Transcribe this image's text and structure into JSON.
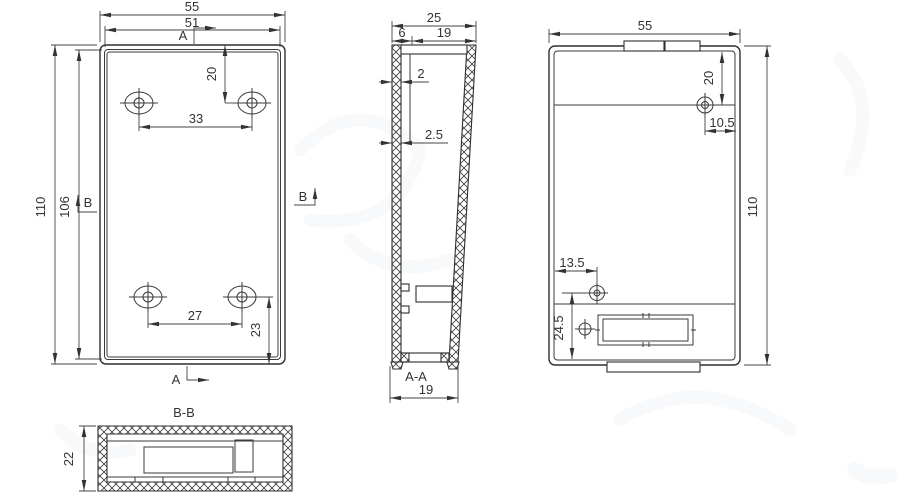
{
  "drawing": {
    "front_view": {
      "dim_width_outer": "55",
      "dim_width_inner": "51",
      "dim_height_outer": "110",
      "dim_height_inner": "106",
      "dim_hole_top_offset": "20",
      "dim_hole_spacing_top": "33",
      "dim_hole_spacing_bottom": "27",
      "dim_hole_bottom_offset": "23",
      "section_marker_a": "A",
      "section_marker_b": "B"
    },
    "section_aa": {
      "label": "A-A",
      "dim_depth_outer": "25",
      "dim_lid": "6",
      "dim_body": "19",
      "dim_wall_top": "2",
      "dim_wall_side": "2.5",
      "dim_depth_bottom": "19"
    },
    "back_view": {
      "dim_width": "55",
      "dim_height": "110",
      "dim_hole_top_offset": "20",
      "dim_hole_right_offset": "10.5",
      "dim_boss_left_offset": "13.5",
      "dim_boss_bottom_offset": "24.5"
    },
    "section_bb": {
      "label": "B-B",
      "dim_height": "22"
    }
  }
}
